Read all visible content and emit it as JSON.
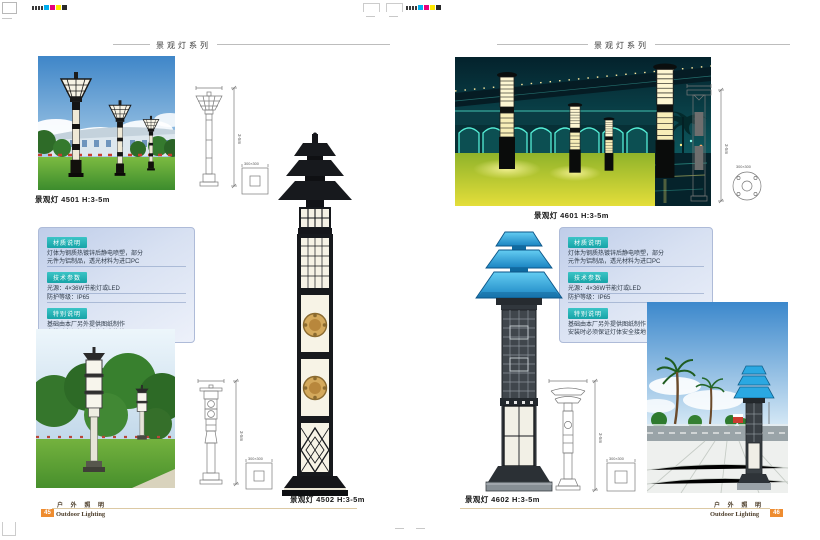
{
  "header": {
    "series_title": "景观灯系列"
  },
  "products": {
    "p4501": "景观灯  4501  H:3-5m",
    "p4502": "景观灯  4502  H:3-5m",
    "p4601": "景观灯  4601  H:3-5m",
    "p4602": "景观灯  4602  H:3-5m"
  },
  "info": {
    "material_badge": "材质说明",
    "material_line1": "灯体为钢质热镀锌后静电喷塑，部分",
    "material_line2": "元件为铝制品，透光材料为进口PC",
    "tech_badge": "技术参数",
    "tech_line1": "光源：4×36W节能灯或LED",
    "tech_line2": "防护等级：IP65",
    "special_badge": "特别说明",
    "special_line1": "基础由本厂另外提供图纸制作",
    "special_line2": "安装时必须保证灯体安全接地"
  },
  "dims": {
    "height": "3-5m",
    "base": "300×300"
  },
  "footer": {
    "cn": "户 外 照 明",
    "en": "Outdoor Lighting",
    "left_page_no": "45",
    "right_page_no": "46"
  },
  "colors": {
    "badge_teal": "#16a3a7",
    "footer_orange": "#ee8c30",
    "blue_lamp": "#2aa8e0",
    "infobox_blue": "#bfcde9",
    "cmyk": [
      "#00AEEF",
      "#E6007E",
      "#FFE800",
      "#2a2a2a"
    ]
  }
}
